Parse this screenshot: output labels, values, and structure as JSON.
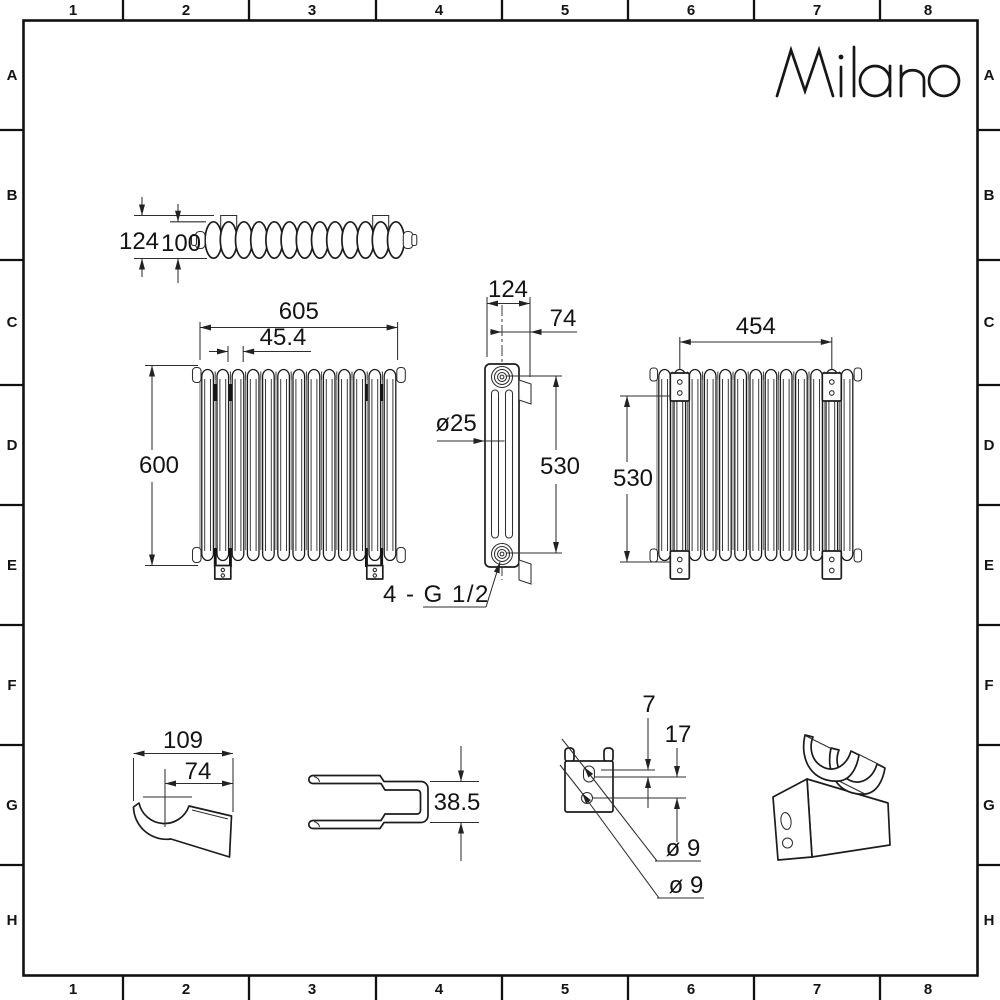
{
  "brand": {
    "logo": "Milano"
  },
  "grid": {
    "columns": [
      "1",
      "2",
      "3",
      "4",
      "5",
      "6",
      "7",
      "8"
    ],
    "rows": [
      "A",
      "B",
      "C",
      "D",
      "E",
      "F",
      "G",
      "H"
    ]
  },
  "drawing": {
    "top_view": {
      "overall_depth": "124",
      "body_depth": "100"
    },
    "front_view": {
      "overall_width": "605",
      "column_pitch": "45.4",
      "overall_height": "600"
    },
    "side_view": {
      "overall_depth": "124",
      "bracket_offset": "74",
      "column_diameter": "ø25",
      "bracket_vertical_spacing": "530",
      "connections": "4 - G 1/2"
    },
    "rear_view": {
      "bracket_horizontal_spacing": "454",
      "bracket_vertical_spacing": "530"
    },
    "bracket_side_view": {
      "overall_width": "109",
      "saddle_offset": "74"
    },
    "bracket_top_view": {
      "overall_width": "38.5"
    },
    "bracket_rear_view": {
      "slot_offset": "7",
      "hole_spacing": "17",
      "slot_diameter": "ø 9",
      "hole_diameter": "ø 9"
    }
  }
}
